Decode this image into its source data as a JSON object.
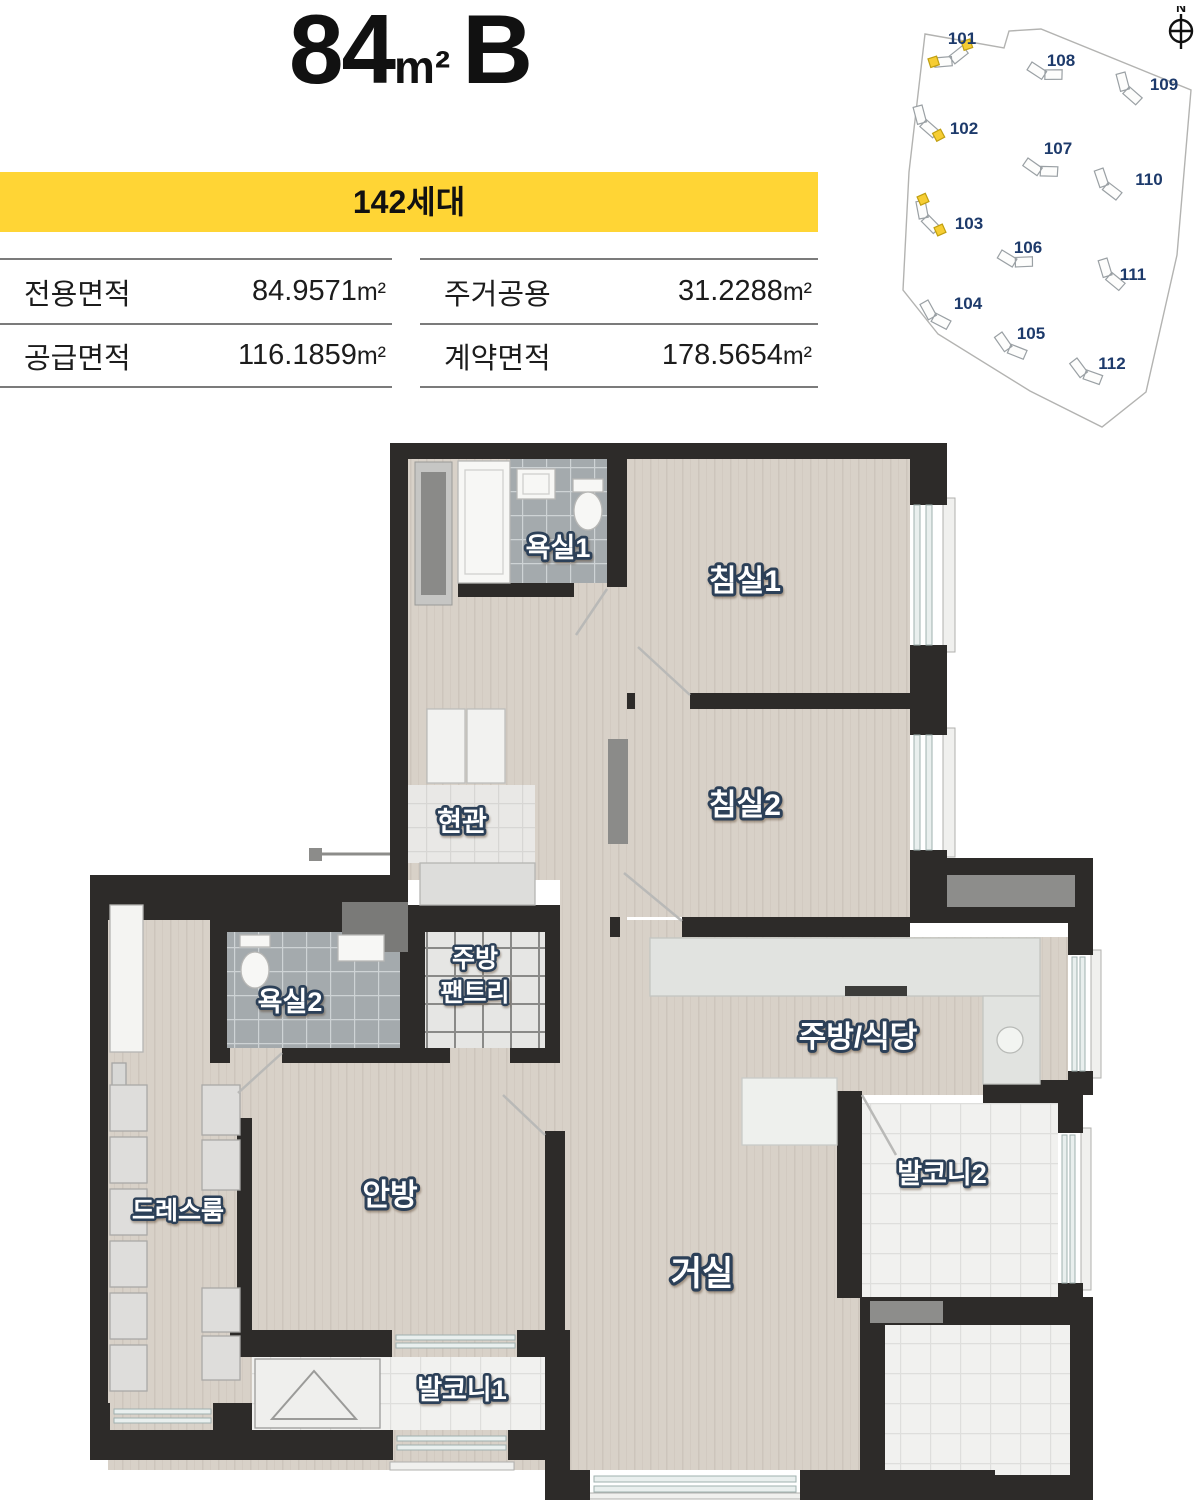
{
  "header": {
    "area_number": "84",
    "area_unit": "m²",
    "type_label": "B"
  },
  "banner": {
    "households": "142세대",
    "bg_color": "#ffd535"
  },
  "areas": {
    "left": [
      {
        "label": "전용면적",
        "value": "84.9571",
        "unit": "m²"
      },
      {
        "label": "공급면적",
        "value": "116.1859",
        "unit": "m²"
      }
    ],
    "right": [
      {
        "label": "주거공용",
        "value": "31.2288",
        "unit": "m²"
      },
      {
        "label": "계약면적",
        "value": "178.5654",
        "unit": "m²"
      }
    ]
  },
  "sitemap": {
    "compass": "N",
    "highlight_color": "#f6cd33",
    "buildings": [
      {
        "id": "101",
        "highlighted": true
      },
      {
        "id": "102",
        "highlighted": true
      },
      {
        "id": "103",
        "highlighted": true
      },
      {
        "id": "104",
        "highlighted": false
      },
      {
        "id": "105",
        "highlighted": false
      },
      {
        "id": "106",
        "highlighted": false
      },
      {
        "id": "107",
        "highlighted": false
      },
      {
        "id": "108",
        "highlighted": false
      },
      {
        "id": "109",
        "highlighted": false
      },
      {
        "id": "110",
        "highlighted": false
      },
      {
        "id": "111",
        "highlighted": false
      },
      {
        "id": "112",
        "highlighted": false
      }
    ]
  },
  "floorplan": {
    "wall_color": "#2d2b29",
    "rooms": {
      "bath1": "욕실1",
      "bed1": "침실1",
      "bed2": "침실2",
      "entrance": "현관",
      "pantry1": "주방",
      "pantry2": "팬트리",
      "bath2": "욕실2",
      "kitchen": "주방/식당",
      "balcony2": "발코니2",
      "dressroom": "드레스룸",
      "master": "안방",
      "living": "거실",
      "balcony1": "발코니1"
    }
  }
}
